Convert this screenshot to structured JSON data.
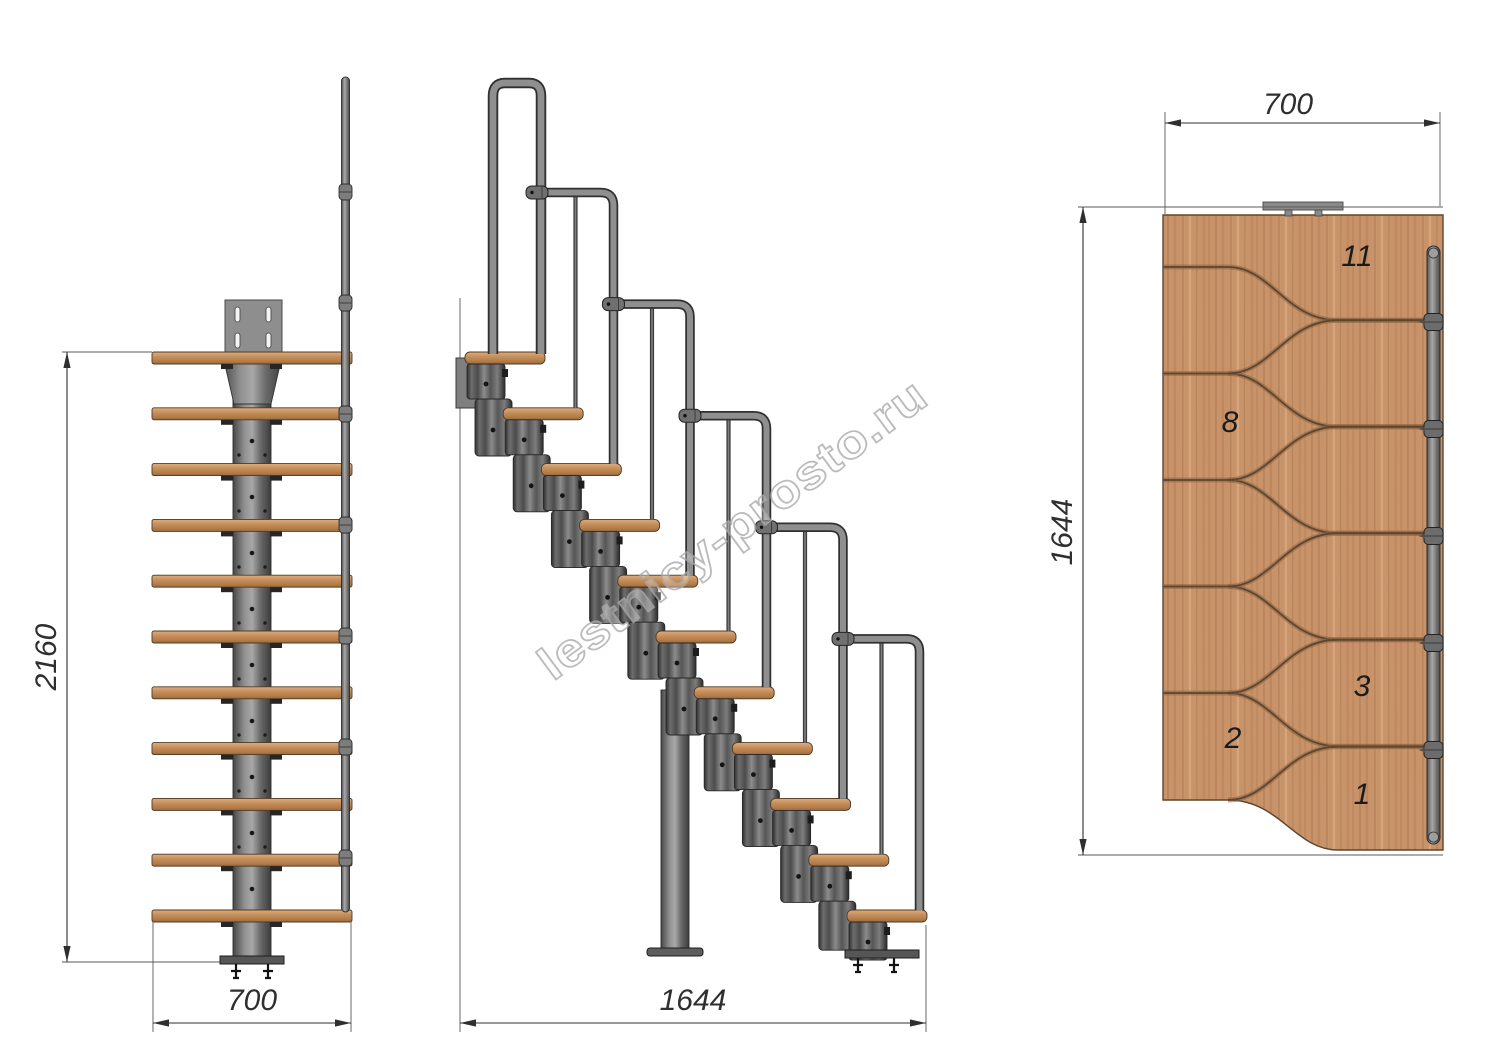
{
  "watermark": {
    "text": "lestnicy-prosto.ru"
  },
  "front_view": {
    "height_dim": "2160",
    "width_dim": "700"
  },
  "side_view": {
    "length_dim": "1644"
  },
  "plan_view": {
    "width_dim": "700",
    "length_dim": "1644",
    "step_labels": [
      "11",
      "8",
      "3",
      "2",
      "1"
    ]
  },
  "colors": {
    "background": "#ffffff",
    "wood": "#c9936a",
    "wood_line": "#5d452f",
    "metal": "#8f8f8f",
    "metal_dark": "#3d3d3d",
    "rail": "#8d8d8d",
    "dim": "#2f2f2f",
    "ink": "#1a1a1a",
    "watermark": "#ababab"
  }
}
